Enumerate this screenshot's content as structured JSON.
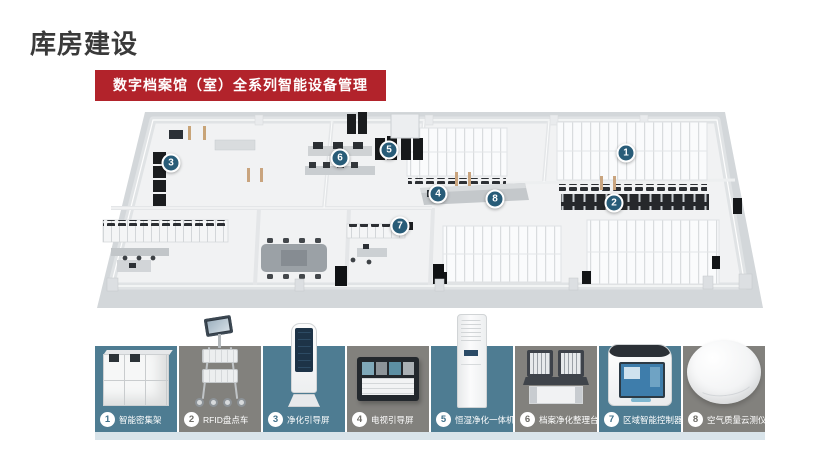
{
  "title": "库房建设",
  "banner": "数字档案馆（室）全系列智能设备管理",
  "colors": {
    "title_color": "#3a3a3a",
    "banner_bg": "#b2232b",
    "tile_teal": "#4e7c92",
    "tile_gray": "#82817d",
    "marker_bg": "#285c78",
    "strip_bg": "#d9e4ea"
  },
  "floor_plan": {
    "markers": [
      {
        "num": "1"
      },
      {
        "num": "2"
      },
      {
        "num": "3"
      },
      {
        "num": "4"
      },
      {
        "num": "5"
      },
      {
        "num": "6"
      },
      {
        "num": "7"
      },
      {
        "num": "8"
      }
    ]
  },
  "equipment": [
    {
      "num": "1",
      "label": "智能密集架"
    },
    {
      "num": "2",
      "label": "RFID盘点车"
    },
    {
      "num": "3",
      "label": "净化引导屏"
    },
    {
      "num": "4",
      "label": "电视引导屏"
    },
    {
      "num": "5",
      "label": "恒湿净化一体机"
    },
    {
      "num": "6",
      "label": "档案净化整理台"
    },
    {
      "num": "7",
      "label": "区域智能控制器"
    },
    {
      "num": "8",
      "label": "空气质量云测仪"
    }
  ]
}
